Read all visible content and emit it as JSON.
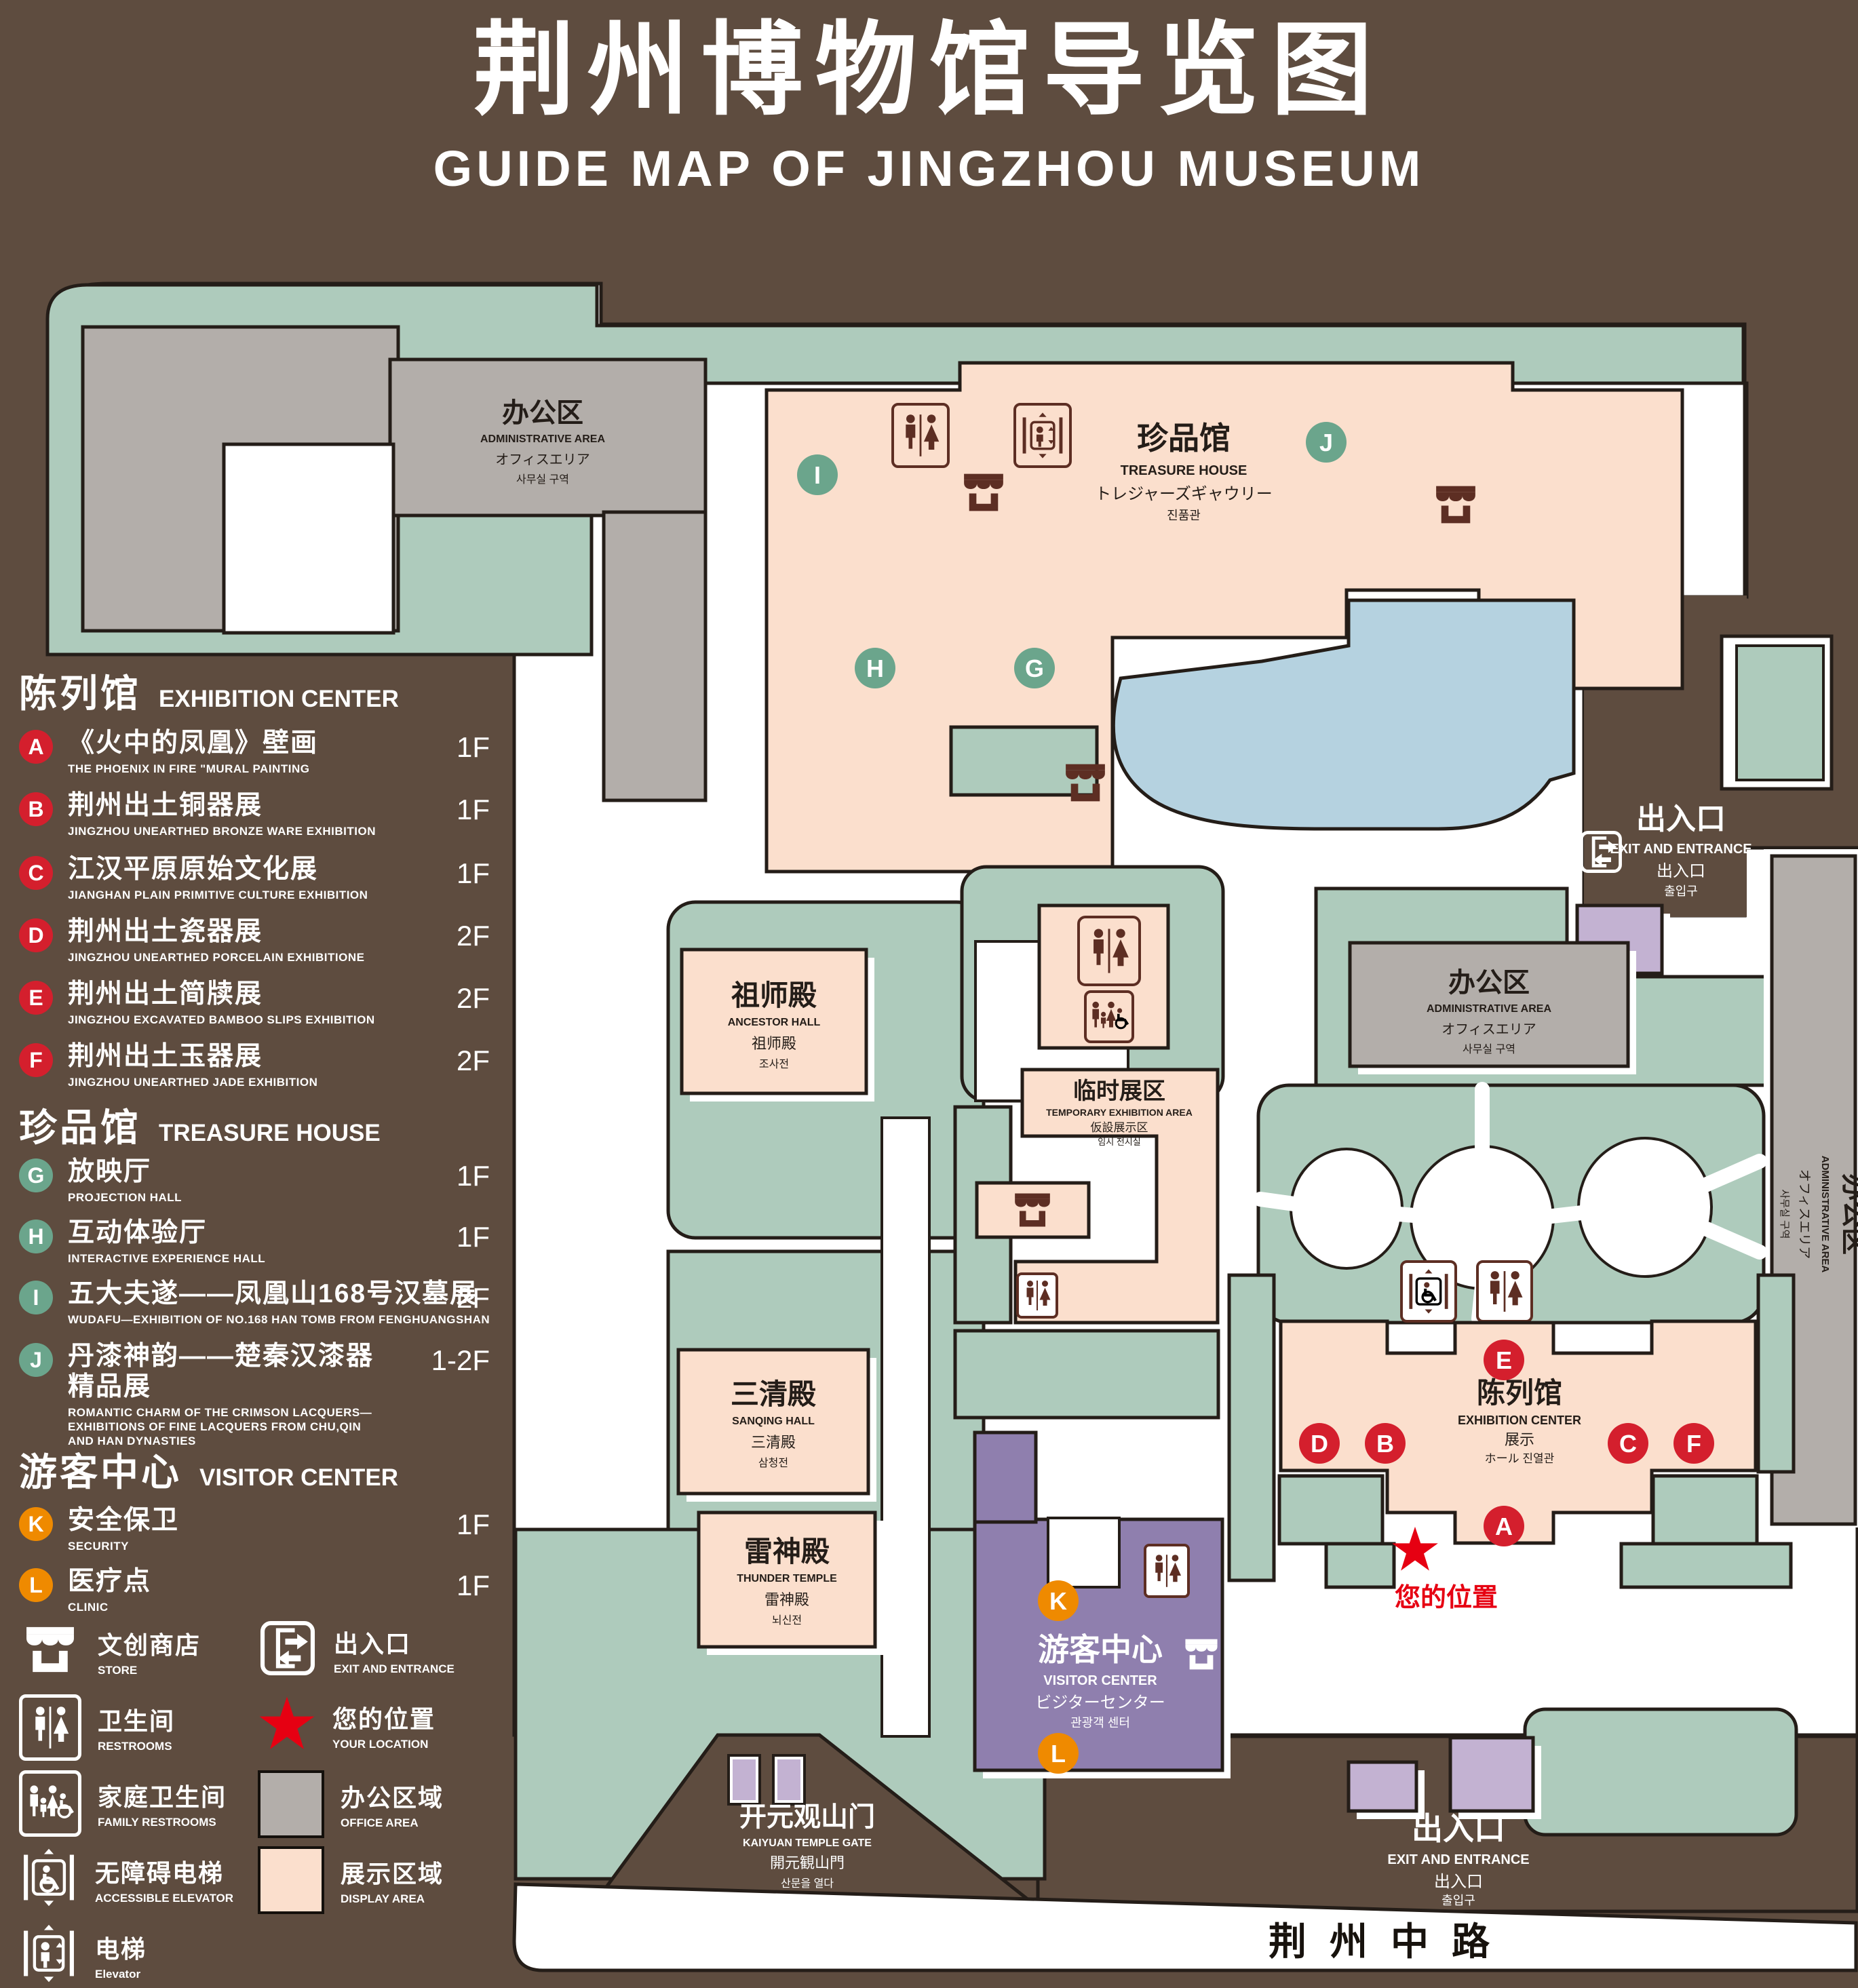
{
  "title": {
    "zh": "荆州博物馆导览图",
    "en": "GUIDE MAP OF JINGZHOU MUSEUM"
  },
  "legend": {
    "sections": [
      {
        "heading_zh": "陈列馆",
        "heading_en": "EXHIBITION CENTER",
        "items": [
          {
            "letter": "A",
            "zh": "《火中的凤凰》壁画",
            "en": "THE PHOENIX IN FIRE \"MURAL PAINTING",
            "floor": "1F"
          },
          {
            "letter": "B",
            "zh": "荆州出土铜器展",
            "en": "JINGZHOU UNEARTHED BRONZE WARE EXHIBITION",
            "floor": "1F"
          },
          {
            "letter": "C",
            "zh": "江汉平原原始文化展",
            "en": "JIANGHAN PLAIN PRIMITIVE CULTURE EXHIBITION",
            "floor": "1F"
          },
          {
            "letter": "D",
            "zh": "荆州出土瓷器展",
            "en": "JINGZHOU UNEARTHED PORCELAIN EXHIBITIONE",
            "floor": "2F"
          },
          {
            "letter": "E",
            "zh": "荆州出土简牍展",
            "en": "JINGZHOU EXCAVATED BAMBOO SLIPS EXHIBITION",
            "floor": "2F"
          },
          {
            "letter": "F",
            "zh": "荆州出土玉器展",
            "en": "JINGZHOU UNEARTHED JADE EXHIBITION",
            "floor": "2F"
          }
        ]
      },
      {
        "heading_zh": "珍品馆",
        "heading_en": "TREASURE HOUSE",
        "items": [
          {
            "letter": "G",
            "zh": "放映厅",
            "en": "PROJECTION HALL",
            "floor": "1F"
          },
          {
            "letter": "H",
            "zh": "互动体验厅",
            "en": "INTERACTIVE EXPERIENCE HALL",
            "floor": "1F"
          },
          {
            "letter": "I",
            "zh": "五大夫遂——凤凰山168号汉墓展",
            "en": "WUDAFU—EXHIBITION OF NO.168 HAN TOMB FROM FENGHUANGSHAN",
            "floor": "2F"
          },
          {
            "letter": "J",
            "zh": "丹漆神韵——楚秦汉漆器精品展",
            "en": "ROMANTIC CHARM OF THE CRIMSON LACQUERS—EXHIBITIONS OF FINE LACQUERS FROM CHU,QIN AND HAN DYNASTIES",
            "floor": "1-2F"
          }
        ]
      },
      {
        "heading_zh": "游客中心",
        "heading_en": "VISITOR CENTER",
        "items": [
          {
            "letter": "K",
            "zh": "安全保卫",
            "en": "SECURITY",
            "floor": "1F"
          },
          {
            "letter": "L",
            "zh": "医疗点",
            "en": "CLINIC",
            "floor": "1F"
          }
        ]
      }
    ],
    "symbols": {
      "store": {
        "zh": "文创商店",
        "en": "STORE"
      },
      "exit": {
        "zh": "出入口",
        "en": "EXIT AND ENTRANCE"
      },
      "restroom": {
        "zh": "卫生间",
        "en": "RESTROOMS"
      },
      "location": {
        "zh": "您的位置",
        "en": "YOUR LOCATION"
      },
      "family": {
        "zh": "家庭卫生间",
        "en": "FAMILY RESTROOMS"
      },
      "office": {
        "zh": "办公区域",
        "en": "OFFICE AREA"
      },
      "accessible": {
        "zh": "无障碍电梯",
        "en": "ACCESSIBLE ELEVATOR"
      },
      "display": {
        "zh": "展示区域",
        "en": "DISPLAY AREA"
      },
      "elevator": {
        "zh": "电梯",
        "en": "Elevator"
      }
    }
  },
  "map": {
    "buildings": {
      "admin": {
        "zh": "办公区",
        "en": "ADMINISTRATIVE AREA",
        "ja": "オフィスエリア",
        "ko": "사무실 구역"
      },
      "treasure": {
        "zh": "珍品馆",
        "en": "TREASURE HOUSE",
        "ja": "トレジャーズギャウリー",
        "ko": "진품관"
      },
      "ancestor": {
        "zh": "祖师殿",
        "en": "ANCESTOR HALL",
        "ja": "祖师殿",
        "ko": "조사전"
      },
      "sanqing": {
        "zh": "三清殿",
        "en": "SANQING HALL",
        "ja": "三清殿",
        "ko": "삼청전"
      },
      "thunder": {
        "zh": "雷神殿",
        "en": "THUNDER TEMPLE",
        "ja": "雷神殿",
        "ko": "뇌신전"
      },
      "temporary": {
        "zh": "临时展区",
        "en": "TEMPORARY EXHIBITION AREA",
        "ja": "仮設展示区",
        "ko": "임시 전시실"
      },
      "visitor": {
        "zh": "游客中心",
        "en": "VISITOR CENTER",
        "ja": "ビジターセンター",
        "ko": "관광객 센터"
      },
      "gate": {
        "zh": "开元观山门",
        "en": "KAIYUAN TEMPLE GATE",
        "ja": "開元観山門",
        "ko": "산문을 열다"
      }
    },
    "exit": {
      "zh": "出入口",
      "en": "EXIT AND ENTRANCE",
      "ja": "出入口",
      "ko": "출입구"
    },
    "your_location": "您的位置",
    "road": "荆州中路",
    "colors": {
      "background": "#5e4c3f",
      "walkway": "#ffffff",
      "green": "#aecbbc",
      "display_area": "#fbdfcd",
      "office_area": "#b3aeaa",
      "lake": "#b5d2e0",
      "visitor_center": "#8f7fae",
      "accent_purple": "#c3b2d2",
      "marker_red": "#d41f2d",
      "marker_green": "#6ba58c",
      "marker_orange": "#ef8a00",
      "icon_brown": "#5d2e23",
      "location_red": "#e60012"
    }
  }
}
